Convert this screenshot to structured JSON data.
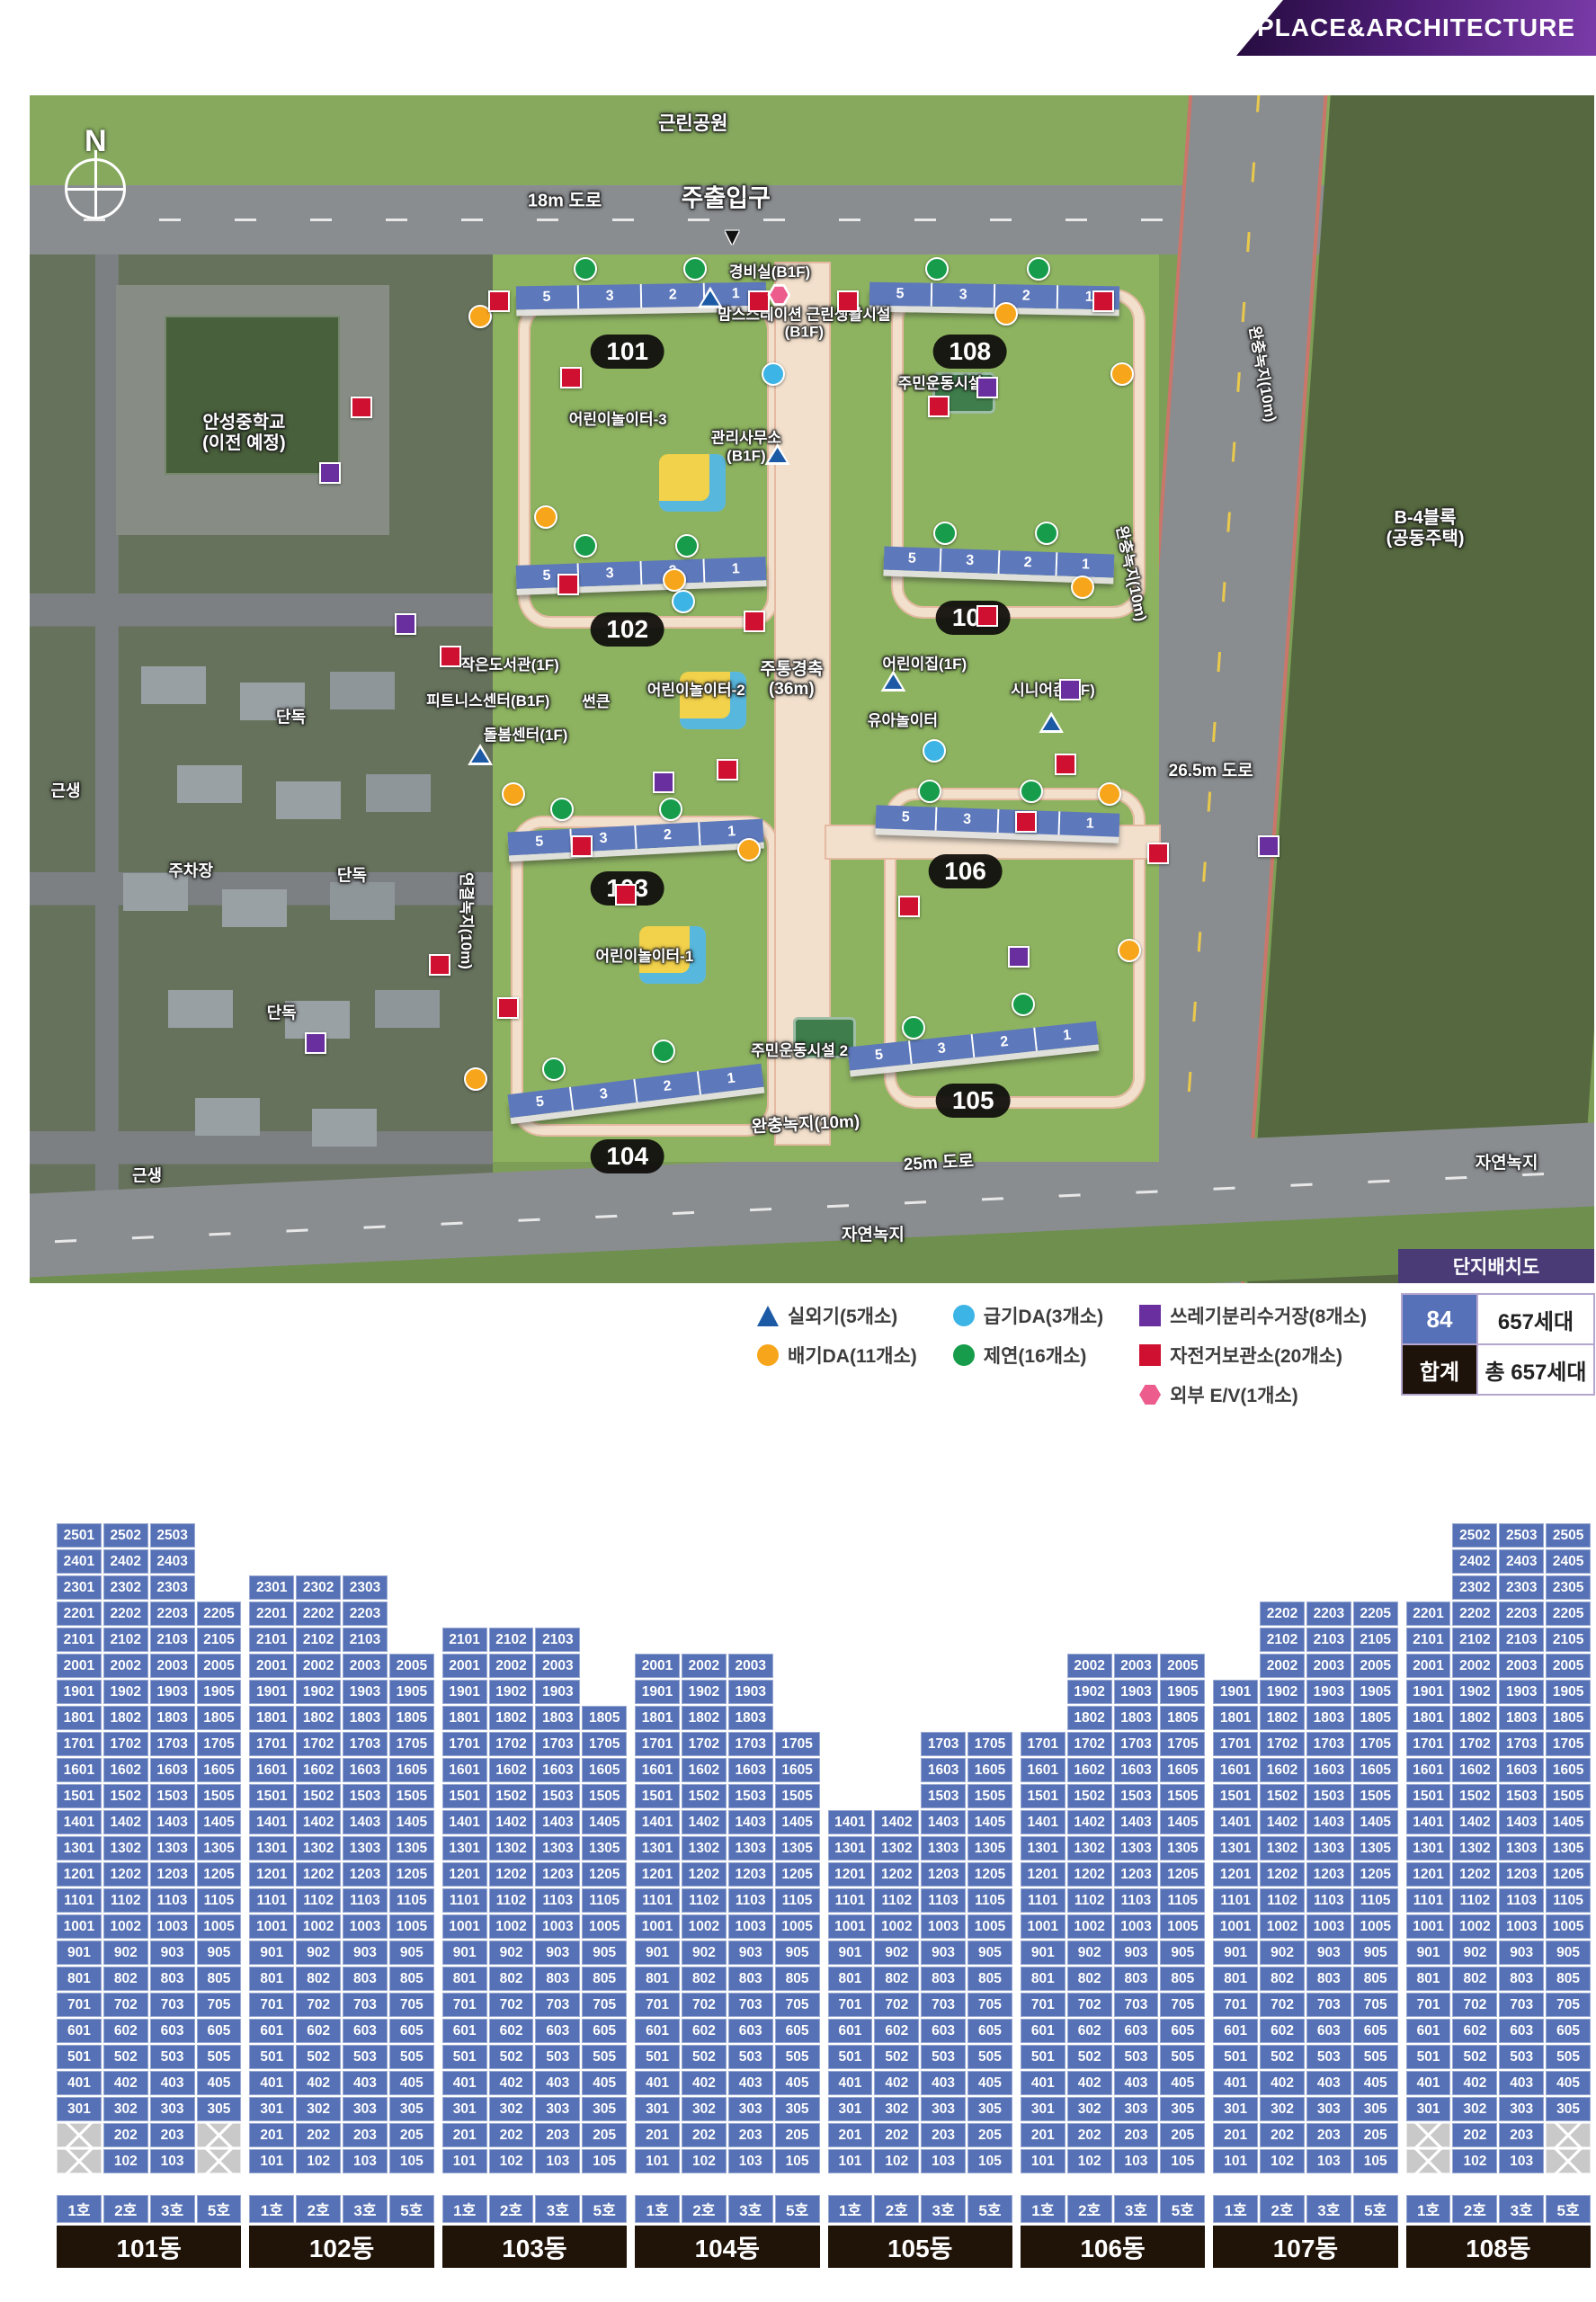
{
  "banner": {
    "label": "PLACE&ARCHITECTURE"
  },
  "map": {
    "compass": "N",
    "badge": "단지배치도",
    "entry_arrow": "▼",
    "buildings": [
      {
        "label": "101",
        "units": [
          "5",
          "3",
          "2",
          "1"
        ],
        "bar": {
          "x": 31.1,
          "y": 15.9,
          "w": 16.0,
          "rot": -1
        },
        "pill": {
          "x": 38.2,
          "y": 21.6
        }
      },
      {
        "label": "108",
        "units": [
          "5",
          "3",
          "2",
          "1"
        ],
        "bar": {
          "x": 53.7,
          "y": 15.9,
          "w": 16.0,
          "rot": 1
        },
        "pill": {
          "x": 60.1,
          "y": 21.6
        }
      },
      {
        "label": "102",
        "units": [
          "5",
          "3",
          "2",
          "1"
        ],
        "bar": {
          "x": 31.1,
          "y": 39.2,
          "w": 16.0,
          "rot": -2
        },
        "pill": {
          "x": 38.2,
          "y": 45.0
        }
      },
      {
        "label": "107",
        "units": [
          "5",
          "3",
          "2",
          "1"
        ],
        "bar": {
          "x": 54.6,
          "y": 38.3,
          "w": 14.7,
          "rot": 2
        },
        "pill": {
          "x": 60.3,
          "y": 44.0
        }
      },
      {
        "label": "103",
        "units": [
          "5",
          "3",
          "2",
          "1"
        ],
        "bar": {
          "x": 30.6,
          "y": 61.5,
          "w": 16.3,
          "rot": -3
        },
        "pill": {
          "x": 38.2,
          "y": 66.8
        }
      },
      {
        "label": "106",
        "units": [
          "5",
          "3",
          "2",
          "1"
        ],
        "bar": {
          "x": 54.1,
          "y": 60.1,
          "w": 15.6,
          "rot": 2
        },
        "pill": {
          "x": 59.8,
          "y": 65.3
        }
      },
      {
        "label": "104",
        "units": [
          "5",
          "3",
          "2",
          "1"
        ],
        "bar": {
          "x": 30.6,
          "y": 82.8,
          "w": 16.3,
          "rot": -7
        },
        "pill": {
          "x": 38.2,
          "y": 89.3
        }
      },
      {
        "label": "105",
        "units": [
          "5",
          "3",
          "2",
          "1"
        ],
        "bar": {
          "x": 52.3,
          "y": 79.0,
          "w": 16.0,
          "rot": -6
        },
        "pill": {
          "x": 60.3,
          "y": 84.6
        }
      }
    ],
    "labels": [
      {
        "t": "근린공원",
        "x": 42.4,
        "y": 2.4,
        "s": 21
      },
      {
        "t": "18m 도로",
        "x": 34.2,
        "y": 8.9,
        "s": 20
      },
      {
        "t": "주출입구",
        "x": 44.5,
        "y": 8.7,
        "s": 27
      },
      {
        "t": "경비실(B1F)",
        "x": 47.3,
        "y": 14.9,
        "s": 17
      },
      {
        "lines": [
          "맘스스테이션 근린생활시설",
          "(B1F)"
        ],
        "x": 49.5,
        "y": 19.2,
        "s": 17
      },
      {
        "t": "주민운동시설 1",
        "x": 58.6,
        "y": 24.3,
        "s": 17
      },
      {
        "t": "어린이놀이터-3",
        "x": 37.6,
        "y": 27.3,
        "s": 17
      },
      {
        "lines": [
          "관리사무소",
          "(B1F)"
        ],
        "x": 45.8,
        "y": 29.6,
        "s": 17
      },
      {
        "t": "작은도서관(1F)",
        "x": 30.7,
        "y": 48.0,
        "s": 17
      },
      {
        "t": "피트니스센터(B1F)",
        "x": 29.3,
        "y": 51.0,
        "s": 17
      },
      {
        "t": "썬큰",
        "x": 36.2,
        "y": 51.1,
        "s": 17
      },
      {
        "t": "돌봄센터(1F)",
        "x": 31.7,
        "y": 53.9,
        "s": 17
      },
      {
        "t": "어린이놀이터-2",
        "x": 42.6,
        "y": 50.1,
        "s": 17
      },
      {
        "lines": [
          "주통경축",
          "(36m)"
        ],
        "x": 48.7,
        "y": 49.2,
        "s": 19
      },
      {
        "t": "어린이집(1F)",
        "x": 57.2,
        "y": 47.9,
        "s": 17
      },
      {
        "t": "유아놀이터",
        "x": 55.8,
        "y": 52.7,
        "s": 17
      },
      {
        "t": "시니어존(1F)",
        "x": 65.4,
        "y": 50.1,
        "s": 17
      },
      {
        "t": "26.5m 도로",
        "x": 75.5,
        "y": 56.9,
        "s": 19
      },
      {
        "t": "어린이놀이터-1",
        "x": 39.3,
        "y": 72.5,
        "s": 17
      },
      {
        "t": "주민운동시설 2",
        "x": 49.2,
        "y": 80.5,
        "s": 17
      },
      {
        "t": "완충녹지(10m)",
        "x": 49.6,
        "y": 86.7,
        "s": 19,
        "rot": -3
      },
      {
        "t": "25m 도로",
        "x": 58.1,
        "y": 89.9,
        "s": 19,
        "rot": -3
      },
      {
        "t": "자연녹지",
        "x": 53.9,
        "y": 96.0,
        "s": 19
      },
      {
        "t": "자연녹지",
        "x": 94.4,
        "y": 89.9,
        "s": 19
      },
      {
        "t": "연결녹지(10m)",
        "x": 27.9,
        "y": 69.5,
        "s": 17,
        "rot": 90
      },
      {
        "t": "완충녹지(10m)",
        "x": 70.4,
        "y": 40.3,
        "s": 17,
        "rot": 78
      },
      {
        "t": "완충녹지(10m)",
        "x": 78.8,
        "y": 23.5,
        "s": 17,
        "rot": 80
      },
      {
        "lines": [
          "B-4블록",
          "(공동주택)"
        ],
        "x": 89.2,
        "y": 36.5,
        "s": 20
      },
      {
        "lines": [
          "안성중학교",
          "(이전 예정)"
        ],
        "x": 13.7,
        "y": 28.5,
        "s": 20
      },
      {
        "t": "단독",
        "x": 16.7,
        "y": 52.4,
        "s": 18
      },
      {
        "t": "단독",
        "x": 20.6,
        "y": 65.7,
        "s": 18
      },
      {
        "t": "단독",
        "x": 16.1,
        "y": 77.3,
        "s": 18
      },
      {
        "t": "근생",
        "x": 2.3,
        "y": 58.6,
        "s": 18
      },
      {
        "t": "근생",
        "x": 7.5,
        "y": 91.0,
        "s": 18
      },
      {
        "t": "주차장",
        "x": 10.3,
        "y": 65.3,
        "s": 18
      }
    ],
    "markers": {
      "triangle": [
        {
          "x": 43.5,
          "y": 17.0
        },
        {
          "x": 28.8,
          "y": 55.5
        },
        {
          "x": 55.2,
          "y": 49.3
        },
        {
          "x": 65.3,
          "y": 52.8
        },
        {
          "x": 47.8,
          "y": 30.2
        }
      ],
      "orange": [
        {
          "x": 28.8,
          "y": 18.6
        },
        {
          "x": 62.4,
          "y": 18.4
        },
        {
          "x": 41.2,
          "y": 40.8
        },
        {
          "x": 67.3,
          "y": 41.4
        },
        {
          "x": 30.9,
          "y": 58.8
        },
        {
          "x": 69.0,
          "y": 58.8
        },
        {
          "x": 28.5,
          "y": 82.8
        },
        {
          "x": 70.3,
          "y": 72.0
        },
        {
          "x": 69.8,
          "y": 23.5
        },
        {
          "x": 46.0,
          "y": 63.5
        },
        {
          "x": 33.0,
          "y": 35.5
        }
      ],
      "skyblue": [
        {
          "x": 41.8,
          "y": 42.6
        },
        {
          "x": 47.5,
          "y": 23.5
        },
        {
          "x": 57.8,
          "y": 55.2
        }
      ],
      "green": [
        {
          "x": 35.5,
          "y": 14.6
        },
        {
          "x": 42.5,
          "y": 14.6
        },
        {
          "x": 58.0,
          "y": 14.6
        },
        {
          "x": 64.5,
          "y": 14.6
        },
        {
          "x": 35.5,
          "y": 37.9
        },
        {
          "x": 42.0,
          "y": 37.9
        },
        {
          "x": 58.5,
          "y": 36.9
        },
        {
          "x": 65.0,
          "y": 36.9
        },
        {
          "x": 34.0,
          "y": 60.1
        },
        {
          "x": 41.0,
          "y": 60.1
        },
        {
          "x": 57.5,
          "y": 58.6
        },
        {
          "x": 64.0,
          "y": 58.6
        },
        {
          "x": 33.5,
          "y": 82.0
        },
        {
          "x": 40.5,
          "y": 80.5
        },
        {
          "x": 56.5,
          "y": 78.5
        },
        {
          "x": 63.5,
          "y": 76.5
        }
      ],
      "purple": [
        {
          "x": 19.2,
          "y": 31.8
        },
        {
          "x": 61.2,
          "y": 24.6
        },
        {
          "x": 40.5,
          "y": 57.8
        },
        {
          "x": 66.5,
          "y": 50.0
        },
        {
          "x": 18.3,
          "y": 79.8
        },
        {
          "x": 79.2,
          "y": 63.2
        },
        {
          "x": 24.0,
          "y": 44.5
        },
        {
          "x": 63.2,
          "y": 72.5
        }
      ],
      "red": [
        {
          "x": 30.0,
          "y": 17.3
        },
        {
          "x": 46.6,
          "y": 17.3
        },
        {
          "x": 52.3,
          "y": 17.3
        },
        {
          "x": 68.6,
          "y": 17.3
        },
        {
          "x": 21.2,
          "y": 26.3
        },
        {
          "x": 34.6,
          "y": 23.8
        },
        {
          "x": 58.1,
          "y": 26.2
        },
        {
          "x": 34.4,
          "y": 41.2
        },
        {
          "x": 46.3,
          "y": 44.3
        },
        {
          "x": 61.2,
          "y": 43.8
        },
        {
          "x": 26.9,
          "y": 47.2
        },
        {
          "x": 44.6,
          "y": 56.8
        },
        {
          "x": 35.3,
          "y": 63.2
        },
        {
          "x": 38.1,
          "y": 67.3
        },
        {
          "x": 63.7,
          "y": 61.2
        },
        {
          "x": 72.1,
          "y": 63.8
        },
        {
          "x": 26.2,
          "y": 73.2
        },
        {
          "x": 30.6,
          "y": 76.8
        },
        {
          "x": 56.2,
          "y": 68.3
        },
        {
          "x": 66.2,
          "y": 56.3
        }
      ],
      "pink": [
        {
          "x": 47.9,
          "y": 16.8
        }
      ]
    }
  },
  "legend": {
    "colors": {
      "triangle": "#1c5aa5",
      "orange": "#f7a51b",
      "skyblue": "#3cb4e5",
      "green": "#169c4a",
      "purple": "#6a2f9e",
      "red": "#d01030",
      "pink": "#ec5c8d"
    },
    "columns": [
      [
        {
          "shape": "tri",
          "color": "#1c5aa5",
          "label": "실외기(5개소)"
        },
        {
          "shape": "circle",
          "color": "#f7a51b",
          "label": "배기DA(11개소)"
        }
      ],
      [
        {
          "shape": "circle",
          "color": "#3cb4e5",
          "label": "급기DA(3개소)"
        },
        {
          "shape": "circle",
          "color": "#169c4a",
          "label": "제연(16개소)"
        }
      ],
      [
        {
          "shape": "square",
          "color": "#6a2f9e",
          "label": "쓰레기분리수거장(8개소)"
        },
        {
          "shape": "square",
          "color": "#d01030",
          "label": "자전거보관소(20개소)"
        },
        {
          "shape": "hex",
          "color": "#ec5c8d",
          "label": "외부 E/V(1개소)"
        }
      ]
    ],
    "summary": {
      "type_cell": "84",
      "type_value": "657세대",
      "total_cell": "합계",
      "total_value": "총 657세대"
    }
  },
  "grid": {
    "floors_max": 25,
    "col_labels": [
      "1호",
      "2호",
      "3호",
      "5호"
    ],
    "buildings": [
      {
        "name": "101동",
        "cols": [
          {
            "no": 1,
            "min": 3,
            "max": 25,
            "x": [
              1,
              2
            ]
          },
          {
            "no": 2,
            "min": 1,
            "max": 25
          },
          {
            "no": 3,
            "min": 1,
            "max": 25
          },
          {
            "no": 5,
            "min": 3,
            "max": 22,
            "x": [
              1,
              2
            ]
          }
        ]
      },
      {
        "name": "102동",
        "cols": [
          {
            "no": 1,
            "min": 1,
            "max": 23
          },
          {
            "no": 2,
            "min": 1,
            "max": 23
          },
          {
            "no": 3,
            "min": 1,
            "max": 23
          },
          {
            "no": 5,
            "min": 1,
            "max": 20
          }
        ]
      },
      {
        "name": "103동",
        "cols": [
          {
            "no": 1,
            "min": 1,
            "max": 21
          },
          {
            "no": 2,
            "min": 1,
            "max": 21
          },
          {
            "no": 3,
            "min": 1,
            "max": 21
          },
          {
            "no": 5,
            "min": 1,
            "max": 18
          }
        ]
      },
      {
        "name": "104동",
        "cols": [
          {
            "no": 1,
            "min": 1,
            "max": 20
          },
          {
            "no": 2,
            "min": 1,
            "max": 20
          },
          {
            "no": 3,
            "min": 1,
            "max": 20
          },
          {
            "no": 5,
            "min": 1,
            "max": 17
          }
        ]
      },
      {
        "name": "105동",
        "cols": [
          {
            "no": 1,
            "min": 1,
            "max": 14
          },
          {
            "no": 2,
            "min": 1,
            "max": 14
          },
          {
            "no": 3,
            "min": 1,
            "max": 17
          },
          {
            "no": 5,
            "min": 1,
            "max": 17
          }
        ]
      },
      {
        "name": "106동",
        "cols": [
          {
            "no": 1,
            "min": 1,
            "max": 17
          },
          {
            "no": 2,
            "min": 1,
            "max": 20
          },
          {
            "no": 3,
            "min": 1,
            "max": 20
          },
          {
            "no": 5,
            "min": 1,
            "max": 20
          }
        ]
      },
      {
        "name": "107동",
        "cols": [
          {
            "no": 1,
            "min": 1,
            "max": 19
          },
          {
            "no": 2,
            "min": 1,
            "max": 22
          },
          {
            "no": 3,
            "min": 1,
            "max": 22
          },
          {
            "no": 5,
            "min": 1,
            "max": 22
          }
        ]
      },
      {
        "name": "108동",
        "cols": [
          {
            "no": 1,
            "min": 3,
            "max": 22,
            "x": [
              1,
              2
            ]
          },
          {
            "no": 2,
            "min": 1,
            "max": 25
          },
          {
            "no": 3,
            "min": 1,
            "max": 25
          },
          {
            "no": 5,
            "min": 3,
            "max": 25,
            "x": [
              1,
              2
            ]
          }
        ]
      }
    ]
  }
}
